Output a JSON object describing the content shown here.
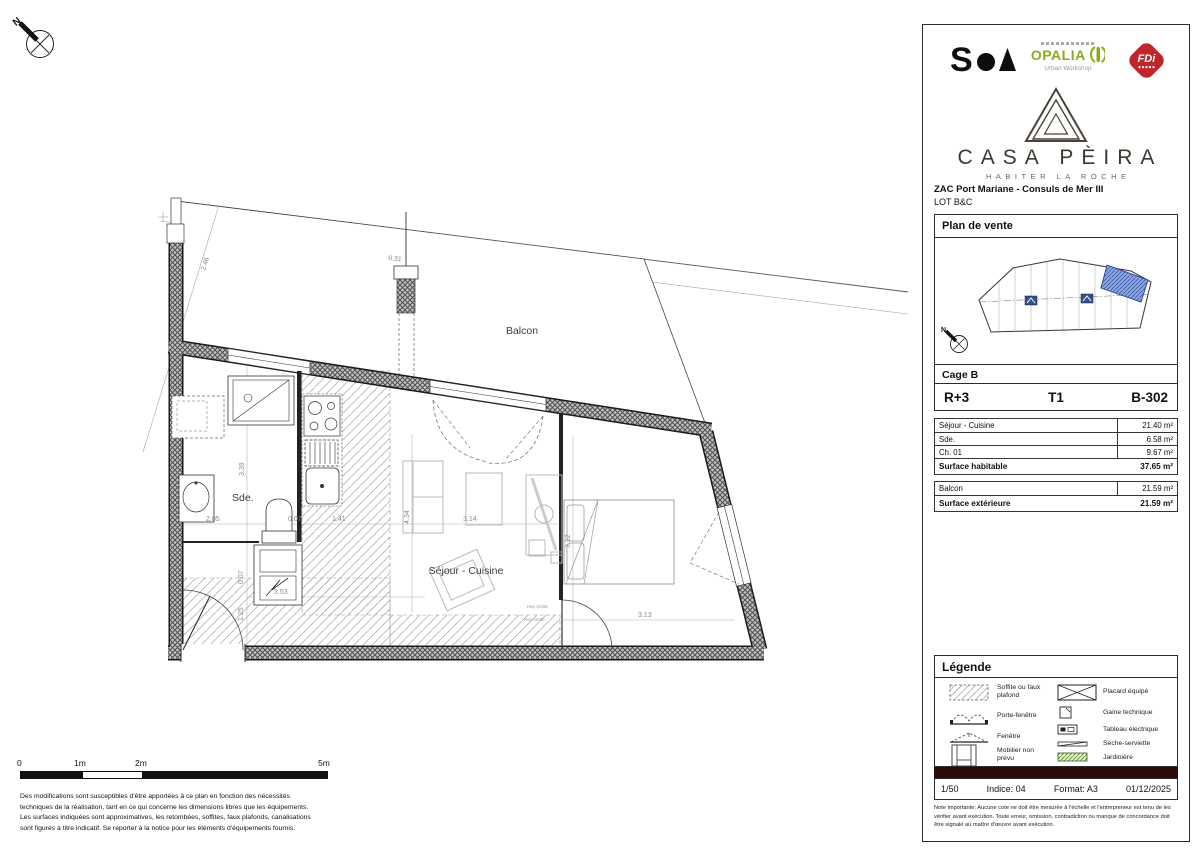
{
  "compass": {
    "label": "N"
  },
  "plan": {
    "labels": {
      "balcony": "Balcon",
      "bathroom": "Sde.",
      "living": "Séjour - Cuisine"
    },
    "dimensions": [
      "2.46",
      "8.31",
      "3.39",
      "2.05",
      "0.07",
      "1.41",
      "4.34",
      "3.14",
      "3.53",
      "1.25",
      "0.07",
      "3.92",
      "3.13"
    ],
    "annotations": [
      "Hsp 2m50",
      "Hsp 2m50"
    ]
  },
  "scale_bar": {
    "ticks": [
      "0",
      "1m",
      "2m",
      "5m"
    ]
  },
  "disclaimer": "Des modifications sont susceptibles d'être apportées à ce plan en fonction des nécessités techniques de la réalisation, tant en ce qui concerne les dimensions libres que les équipements. Les surfaces indiquées sont approximatives, les retombées, soffites, faux plafonds, canalisations sont figurés à titre indicatif. Se reporter à la notice pour les éléments d'équipements fournis.",
  "panel": {
    "logos": {
      "soa": "S",
      "opalia": "OPALIA",
      "opalia_sub": "Urban Workshop",
      "fdi": "FDi"
    },
    "brand": {
      "name": "CASA PÈIRA",
      "tagline": "HABITER LA ROCHE"
    },
    "project": {
      "title": "ZAC Port Mariane - Consuls de Mer III",
      "lot": "LOT B&C"
    },
    "sections": {
      "plan": "Plan de vente",
      "cage": "Cage B",
      "legend": "Légende"
    },
    "unit": {
      "floor": "R+3",
      "type": "T1",
      "ref": "B-302"
    },
    "surfaces": {
      "rows": [
        {
          "label": "Séjour - Cuisine",
          "value": "21.40 m²"
        },
        {
          "label": "Sde.",
          "value": "6.58 m²"
        },
        {
          "label": "Ch. 01",
          "value": "9.67 m²"
        }
      ],
      "total": {
        "label": "Surface habitable",
        "value": "37.65 m²"
      },
      "ext_rows": [
        {
          "label": "Balcon",
          "value": "21.59 m²"
        }
      ],
      "ext_total": {
        "label": "Surface extérieure",
        "value": "21.59 m²"
      }
    },
    "legend": {
      "items": [
        {
          "label": "Soffite ou faux plafond"
        },
        {
          "label": "Porte-fenêtre"
        },
        {
          "label": "Fenêtre"
        },
        {
          "label": "Mobilier non prévu"
        },
        {
          "label": "Placard équipé"
        },
        {
          "label": "Gaine technique"
        },
        {
          "label": "Tableau électrique"
        },
        {
          "label": "Sèche-serviette"
        },
        {
          "label": "Jardinière"
        }
      ]
    },
    "footer": {
      "scale": "1/50",
      "indice": "Indice: 04",
      "format": "Format: A3",
      "date": "01/12/2025"
    },
    "note": "Note importante: Aucune cote ne doit être mesurée à l'échelle et l'entrepreneur est tenu de les vérifier avant exécution. Toute erreur, omission, contradiction ou manque de concordance doit être signalé au maître d'œuvre avant exécution."
  },
  "colors": {
    "unit_highlight": "#8ea8de",
    "footer_bar": "#2d0b0b",
    "opalia_green": "#8aac1c",
    "fdi_red": "#c1252c"
  }
}
